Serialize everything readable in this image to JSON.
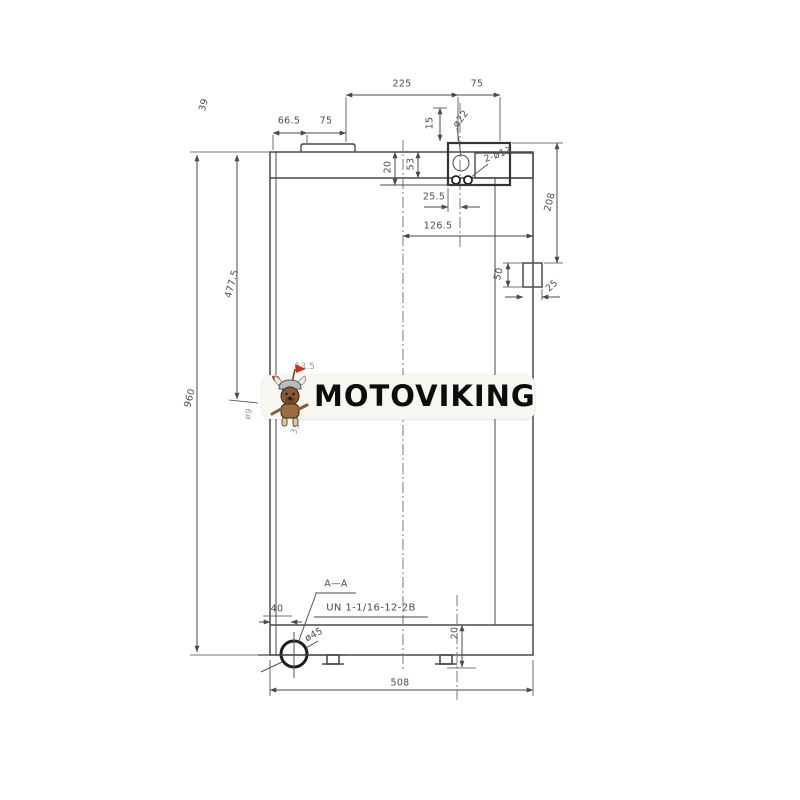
{
  "watermark": {
    "brand": "MOTOVIKING"
  },
  "annotations": {
    "section": "A—A",
    "thread": "UN 1-1/16-12-2B"
  },
  "dims": {
    "top": {
      "tab_to_port": "225",
      "port_to_edge": "75",
      "edge_to_tab": "66.5",
      "tab_width": "75",
      "port_height": "15",
      "port_diameter": "ø22",
      "bolt_holes": "2-ø13",
      "flange_depth": "20",
      "tank_depth": "53",
      "port_offset": "25.5",
      "center_to_edge": "126.5",
      "corner_ref": "39"
    },
    "left": {
      "height_total": "960",
      "upper_height": "477.5"
    },
    "right": {
      "bracket_offset": "208",
      "bracket_height": "50",
      "bracket_width": "25"
    },
    "bottom": {
      "corner_offset": "40",
      "port_diameter": "ø45",
      "foot_inset": "20",
      "width_total": "508"
    },
    "hidden": {
      "a": "13.5",
      "b": "ø9",
      "c": "35"
    }
  }
}
